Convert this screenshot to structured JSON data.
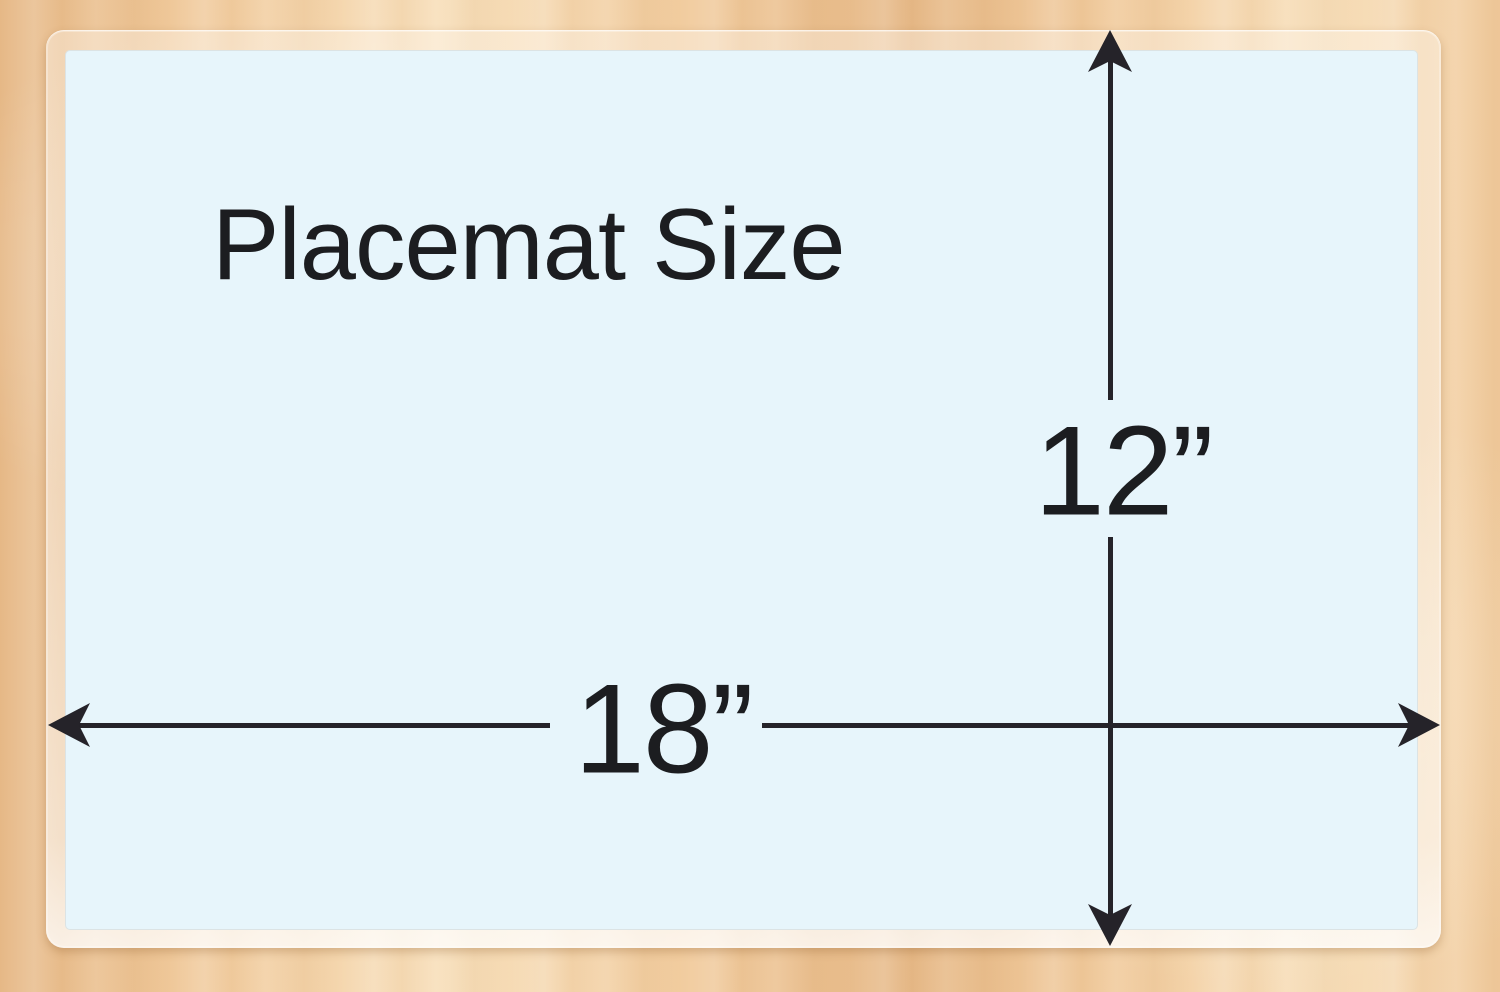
{
  "placemat": {
    "title": "Placemat Size",
    "width_inches": "18”",
    "height_inches": "12”"
  },
  "dimensions": {
    "width_value": 18,
    "height_value": 12,
    "unit": "inches"
  },
  "colors": {
    "wood_base": "#f1cb9d",
    "wood_light": "#f8e0bc",
    "wood_dark": "#e6b886",
    "placemat_blue": "#e7f5fb",
    "laminate_edge": "#f2e4d4",
    "dimension_line": "#252329",
    "text": "#1c1d20"
  }
}
